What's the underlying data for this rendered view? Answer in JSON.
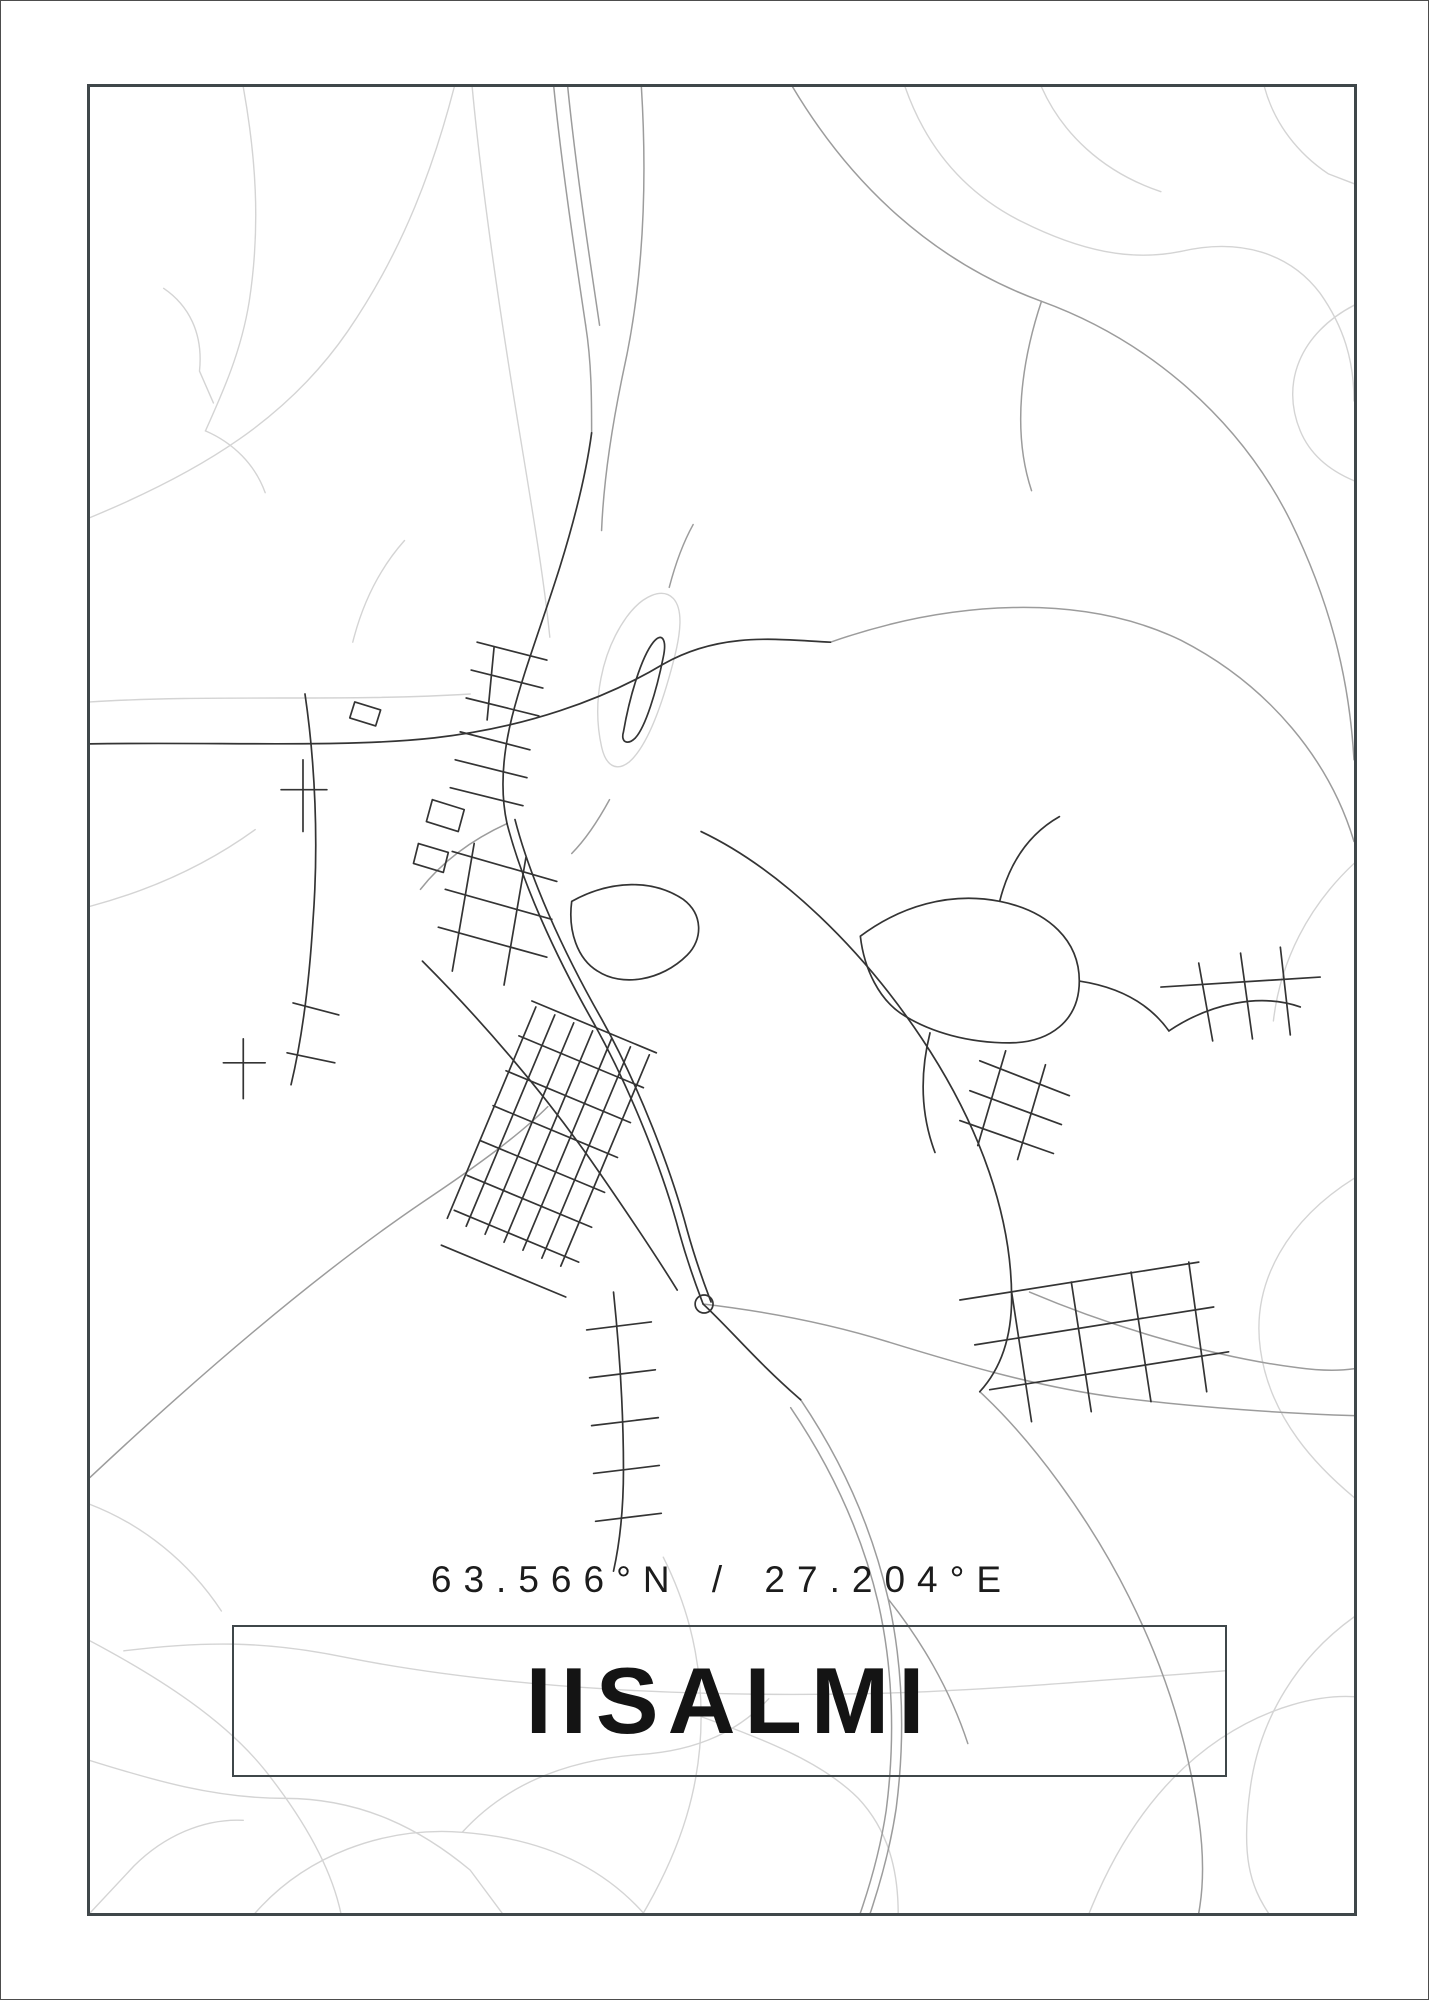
{
  "poster": {
    "coordinates": "63.566°N / 27.204°E",
    "title": "IISALMI",
    "colors": {
      "background": "#ffffff",
      "frame_border": "#3f474a",
      "text": "#1c1c1c",
      "title": "#141414",
      "road_light": "#d4d4d4",
      "road_medium": "#9c9c9c",
      "road_dark": "#343434"
    }
  },
  "map": {
    "description": "Minimalist street map of Iisalmi, Finland",
    "layers": [
      {
        "name": "roads-light",
        "color": "#d4d4d4",
        "stroke_width": 1.4,
        "paths": [
          "M 86 515 C 200 468 285 415 345 328 C 402 245 432 160 452 83",
          "M 240 83 C 252 150 258 220 246 298 C 238 348 220 388 202 428",
          "M 202 428 C 230 440 252 462 262 490",
          "M 160 285 C 185 302 200 330 196 368 L 210 400",
          "M 86 700 C 210 692 340 700 468 692",
          "M 86 1505 C 138 1525 185 1562 218 1612",
          "M 86 1642 C 158 1680 222 1722 262 1772 C 300 1820 328 1868 338 1915",
          "M 86 1762 C 150 1782 212 1800 282 1800 C 360 1800 420 1832 468 1872 L 500 1915",
          "M 252 1915 C 302 1858 380 1828 460 1834 C 540 1840 600 1868 642 1915",
          "M 460 1834 C 500 1790 558 1762 638 1756 C 700 1752 740 1730 768 1700",
          "M 642 1915 C 680 1850 700 1788 700 1718 C 700 1650 682 1598 662 1558",
          "M 120 1652 C 200 1642 262 1642 340 1658 C 500 1690 700 1700 900 1694 C 1010 1690 1120 1680 1226 1672",
          "M 700 1718 C 760 1740 820 1762 858 1800 C 888 1832 898 1872 898 1915",
          "M 905 83 C 925 140 962 188 1022 218 C 1082 248 1132 258 1182 248",
          "M 1182 248 C 1242 234 1292 250 1322 290 C 1346 324 1356 358 1356 398",
          "M 1356 302 C 1302 330 1282 380 1302 428 C 1312 452 1332 468 1356 478",
          "M 1042 83 C 1062 128 1102 168 1162 188",
          "M 1266 83 C 1276 120 1300 150 1330 170 L 1356 180",
          "M 1356 1178 C 1292 1218 1252 1280 1262 1350 C 1272 1420 1320 1468 1356 1498",
          "M 1356 1618 C 1300 1658 1262 1718 1252 1788 C 1242 1858 1252 1888 1270 1915",
          "M 1090 1915 C 1120 1840 1162 1780 1222 1740 C 1270 1708 1320 1696 1356 1698",
          "M 600 745 C 590 700 600 650 625 615 C 641 593 661 585 672 596 C 682 607 680 630 672 660 C 660 706 645 745 628 760 C 614 771 604 763 600 745 Z",
          "M 86 905 C 150 888 205 862 252 828",
          "M 470 83 C 480 190 498 310 516 420 C 530 505 542 575 548 635",
          "M 1356 862 C 1310 905 1282 960 1275 1020",
          "M 86 1915 L 130 1868 C 160 1838 200 1820 240 1822",
          "M 350 640 C 360 600 378 565 402 538"
        ]
      },
      {
        "name": "roads-medium",
        "color": "#9c9c9c",
        "stroke_width": 1.5,
        "paths": [
          "M 552 83 C 560 162 572 242 584 322",
          "M 566 83 C 574 162 586 242 598 322",
          "M 640 83 C 646 180 642 278 622 368 C 610 425 602 478 600 528",
          "M 792 83 C 850 180 932 258 1042 298 C 1152 338 1242 418 1292 518 C 1338 612 1352 690 1356 758",
          "M 1042 298 C 1022 358 1012 428 1032 488",
          "M 830 640 C 950 598 1082 590 1182 638 C 1272 684 1332 760 1356 840",
          "M 86 1478 C 180 1390 302 1282 420 1202 C 480 1162 520 1132 546 1106",
          "M 980 1392 C 1032 1440 1090 1518 1130 1598 C 1170 1678 1190 1750 1200 1820 C 1205 1855 1205 1888 1200 1915",
          "M 1030 1292 C 1120 1330 1220 1358 1300 1368 C 1322 1371 1342 1371 1356 1369",
          "M 702 1304 C 770 1312 830 1324 888 1342 C 966 1366 1042 1388 1120 1398 C 1200 1408 1290 1414 1356 1416",
          "M 584 322 C 590 360 590 396 590 430",
          "M 608 798 C 596 820 584 838 570 852",
          "M 668 585 C 674 562 682 540 692 522",
          "M 800 1400 C 842 1462 872 1530 888 1600 C 903 1668 905 1740 896 1810 C 890 1850 880 1885 870 1915",
          "M 790 1408 C 832 1470 862 1536 878 1604 C 893 1670 895 1742 886 1812 C 880 1852 870 1886 860 1915",
          "M 888 1600 C 920 1640 950 1690 968 1745",
          "M 505 822 C 470 838 440 860 418 888"
        ]
      },
      {
        "name": "roads-dark",
        "color": "#343434",
        "stroke_width": 1.7,
        "paths": [
          "M 86 742 C 222 740 342 746 432 736 C 522 726 602 698 662 662 C 722 628 782 638 830 640",
          "M 590 430 C 584 475 572 520 558 565 C 540 622 522 668 510 715 C 500 755 498 790 505 822",
          "M 505 822 C 520 880 552 952 592 1022 C 630 1090 662 1172 678 1232 C 688 1268 696 1288 702 1304",
          "M 513 818 C 528 876 560 948 600 1018 C 638 1086 670 1170 686 1230 C 696 1266 704 1286 710 1302",
          "M 694 1304 a 9 9 0 1 0 18 0 a 9 9 0 1 0 -18 0",
          "M 702 1304 C 730 1330 756 1362 800 1400",
          "M 420 960 C 480 1020 540 1090 588 1158 C 620 1204 650 1248 676 1290",
          "M 445 1218 L 534 1006",
          "M 464 1226 L 553 1014",
          "M 483 1234 L 572 1022",
          "M 502 1242 L 591 1030",
          "M 521 1250 L 610 1038",
          "M 540 1258 L 629 1046",
          "M 559 1266 L 648 1054",
          "M 530 1000 L 655 1052",
          "M 517 1035 L 642 1087",
          "M 504 1070 L 629 1122",
          "M 491 1105 L 616 1157",
          "M 478 1140 L 603 1192",
          "M 465 1175 L 590 1227",
          "M 452 1210 L 577 1262",
          "M 439 1245 L 564 1297",
          "M 302 692 C 312 760 316 840 310 920 C 306 986 298 1042 288 1084",
          "M 290 1002 L 336 1014",
          "M 284 1052 L 332 1062",
          "M 300 758 L 300 830",
          "M 278 788 L 324 788",
          "M 240 1038 L 240 1098",
          "M 220 1062 L 262 1062",
          "M 475 640 L 545 658",
          "M 469 668 L 541 686",
          "M 464 696 L 537 714",
          "M 492 645 L 485 718",
          "M 458 730 L 528 748",
          "M 453 758 L 525 776",
          "M 448 786 L 521 804",
          "M 430 798 L 462 808 L 456 830 L 424 820 Z",
          "M 416 842 L 446 851 L 441 871 L 411 862 Z",
          "M 352 700 L 378 708 L 373 724 L 347 716 Z",
          "M 622 730 C 628 695 640 655 652 640 C 660 630 666 636 662 655 C 655 690 644 725 634 736 C 626 744 619 740 622 730 Z",
          "M 450 850 L 555 880",
          "M 443 888 L 550 918",
          "M 436 926 L 545 956",
          "M 472 842 L 450 970",
          "M 524 856 L 502 984",
          "M 570 900 C 610 878 652 878 682 898 C 702 913 702 938 686 954 C 660 980 620 986 596 970 C 576 958 566 930 570 900 Z",
          "M 860 935 C 900 905 950 890 1000 900 C 1050 910 1080 940 1080 980 C 1080 1020 1050 1042 1010 1042 C 970 1042 930 1032 900 1012 C 880 998 864 970 860 935 Z",
          "M 1000 900 C 1010 860 1030 832 1060 815",
          "M 1080 980 C 1120 986 1150 1002 1170 1030",
          "M 930 1032 C 920 1072 920 1112 935 1152",
          "M 980 1060 L 1070 1095",
          "M 970 1090 L 1062 1124",
          "M 960 1120 L 1054 1153",
          "M 1006 1050 L 978 1145",
          "M 1046 1064 L 1018 1159",
          "M 1170 1030 C 1212 1002 1262 992 1302 1006",
          "M 1200 962 L 1214 1040",
          "M 1242 952 L 1254 1038",
          "M 1282 946 L 1292 1034",
          "M 1162 986 L 1322 976",
          "M 960 1300 L 1200 1262",
          "M 975 1345 L 1215 1307",
          "M 990 1390 L 1230 1352",
          "M 1012 1292 L 1032 1422",
          "M 1072 1282 L 1092 1412",
          "M 1132 1272 L 1152 1402",
          "M 1190 1262 L 1208 1392",
          "M 700 830 C 780 868 862 948 922 1038 C 982 1128 1012 1218 1012 1298 C 1012 1336 1002 1368 980 1392",
          "M 612 1292 C 618 1350 622 1410 622 1470 C 622 1510 618 1545 612 1572",
          "M 585 1330 L 650 1322",
          "M 588 1378 L 654 1370",
          "M 590 1426 L 657 1418",
          "M 592 1474 L 658 1466",
          "M 594 1522 L 660 1514"
        ]
      }
    ]
  }
}
